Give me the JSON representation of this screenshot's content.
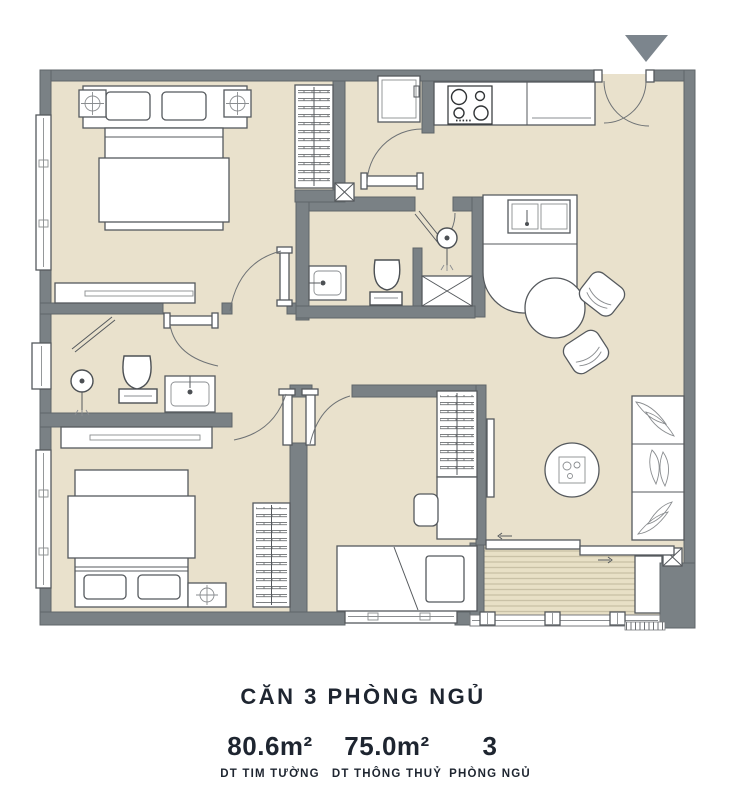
{
  "plan": {
    "title": "CĂN 3 PHÒNG NGỦ",
    "stats": [
      {
        "value": "80.6m²",
        "label": "DT TIM TƯỜNG"
      },
      {
        "value": "75.0m²",
        "label": "DT THÔNG THUỶ"
      },
      {
        "value": "3",
        "label": "PHÒNG NGỦ"
      }
    ],
    "marker": {
      "name": "entrance-marker",
      "shape": "triangle-down",
      "color": "#7c858d"
    },
    "colors": {
      "wall": "#7a8185",
      "floor": "#e9e1cc",
      "deck": "#e8e0c6",
      "deck_stripe": "#c9c1a6",
      "furniture": "#ffffff",
      "text": "#1e2530"
    }
  }
}
